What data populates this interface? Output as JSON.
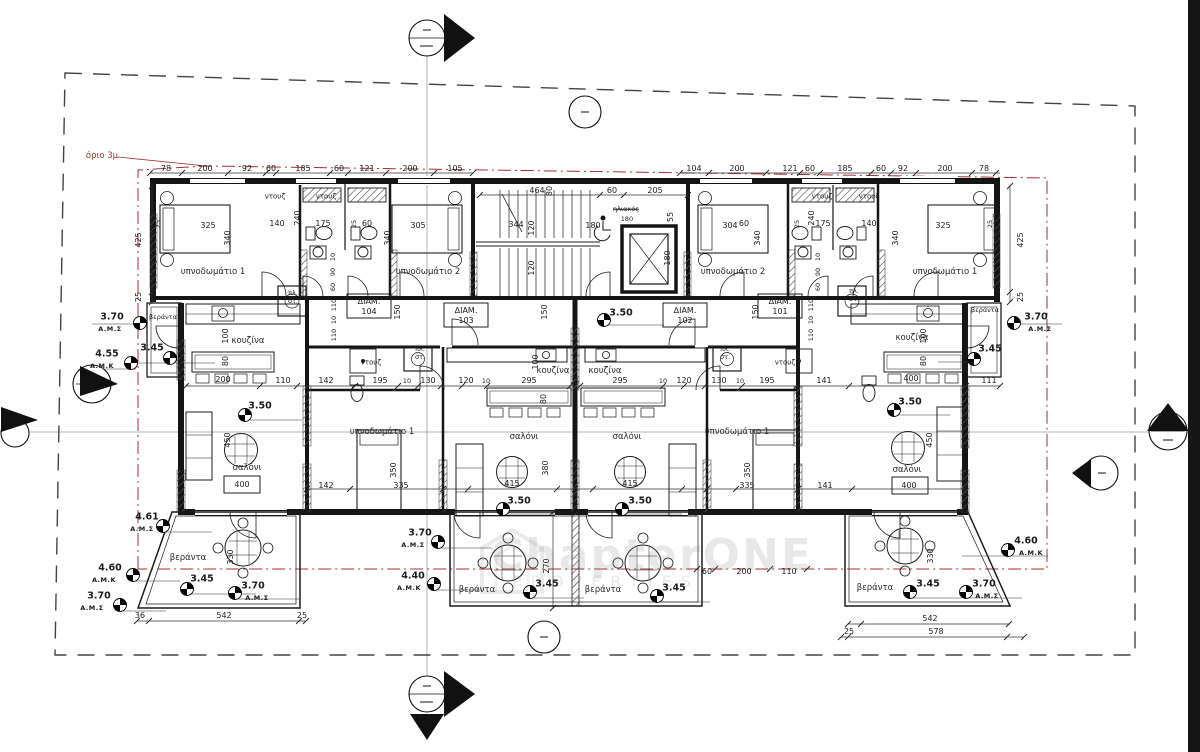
{
  "labels": {
    "boundary": "όριο 3μ",
    "bedroom1": "υπνοδωμάτιο 1",
    "bedroom2": "υπνοδωμάτιο 2",
    "kitchen": "κουζίνα",
    "living": "σαλόνι",
    "veranda": "βεράντα",
    "shower": "ντουζ",
    "laundry1": "πλ.",
    "laundry2": "στ.",
    "solar": "ηλιακός",
    "diam": "ΔΙΑΜ."
  },
  "apartments": {
    "a101": "101",
    "a102": "102",
    "a103": "103",
    "a104": "104"
  },
  "levels": {
    "ams": "Α.Μ.Σ",
    "amk": "Α.Μ.Κ",
    "l350": "3.50",
    "l345": "3.45",
    "l370": "3.70",
    "l440": "4.40",
    "l455": "4.55",
    "l460": "4.60",
    "l461": "4.61"
  },
  "watermark": {
    "brand": "ChapterONE",
    "sub": "PROPERTIES"
  },
  "dims": {
    "d10": "10",
    "d25": "25",
    "d36": "36",
    "d55": "55",
    "d60": "60",
    "d78": "78",
    "d80": "80",
    "d90": "90",
    "d92": "92",
    "d100": "100",
    "d104": "104",
    "d105": "105",
    "d110": "110",
    "d111": "111",
    "d120": "120",
    "d121": "121",
    "d130": "130",
    "d140": "140",
    "d141": "141",
    "d142": "142",
    "d150": "150",
    "d175": "175",
    "d180": "180",
    "d185": "185",
    "d195": "195",
    "d200": "200",
    "d205": "205",
    "d240": "240",
    "d270": "270",
    "d295": "295",
    "d304": "304",
    "d305": "305",
    "d325": "325",
    "d330": "330",
    "d335": "335",
    "d340": "340",
    "d344": "344",
    "d350": "350",
    "d380": "380",
    "d400": "400",
    "d415": "415",
    "d425": "425",
    "d450": "450",
    "d464": "464",
    "d542": "542",
    "d578": "578"
  }
}
